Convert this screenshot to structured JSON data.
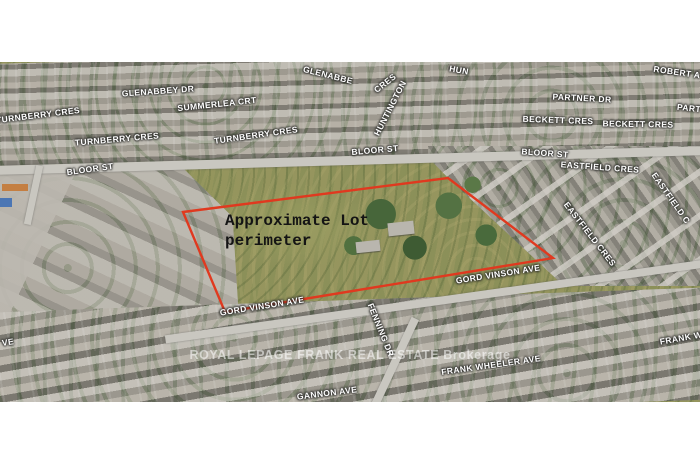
{
  "map": {
    "labels": [
      "GLENABBEY DR",
      "SUMMERLEA CRT",
      "TURNBERRY CRES",
      "TURNBERRY CRES",
      "TURNBERRY CRES",
      "GLENABBE",
      "HUN",
      "CRES",
      "HUNTINGTON",
      "ROBERT A",
      "PARTNER DR",
      "PART",
      "BECKETT CRES",
      "BECKETT CRES",
      "BLOOR ST",
      "BLOOR ST",
      "BLOOR ST",
      "EASTFIELD CRES",
      "EASTFIELD C",
      "EASTFIELD CRES",
      "GORD VINSON AVE",
      "GORD VINSON AVE",
      "FENNING DR",
      "FRANK WHEELER AVE",
      "FRANK W",
      "GANNON AVE",
      "VE"
    ],
    "annotation": {
      "line1": "Approximate Lot",
      "line2": "perimeter"
    },
    "watermark": "ROYAL LEPAGE FRANK REAL ESTATE Brokerage",
    "colors": {
      "perimeter": "#e0391f"
    }
  }
}
